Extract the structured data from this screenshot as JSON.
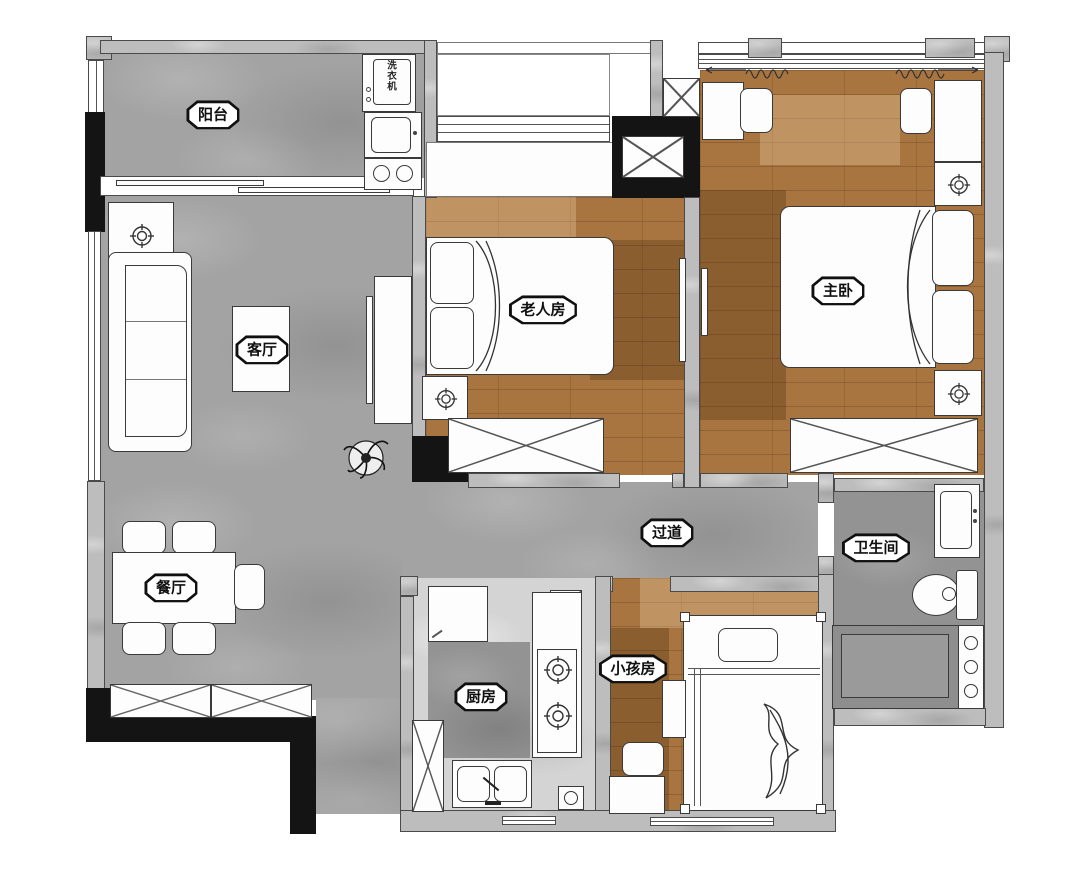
{
  "rooms": {
    "balcony": {
      "label": "阳台"
    },
    "living_room": {
      "label": "客厅"
    },
    "dining_room": {
      "label": "餐厅"
    },
    "elder_room": {
      "label": "老人房"
    },
    "master_bedroom": {
      "label": "主卧"
    },
    "hallway": {
      "label": "过道"
    },
    "bathroom": {
      "label": "卫生间"
    },
    "kitchen": {
      "label": "厨房"
    },
    "kids_room": {
      "label": "小孩房"
    }
  },
  "appliances": {
    "washing_machine": "洗衣机"
  },
  "colors": {
    "tile_floor": "#a3a3a3",
    "bath_floor": "#939393",
    "kitchen_floor": "#d4d4d4",
    "wood_floor": "#a8743f",
    "wall_gray": "#bdbdbd",
    "wall_black": "#141414",
    "furniture": "#fdfdfd",
    "outline": "#3a3a3a"
  }
}
